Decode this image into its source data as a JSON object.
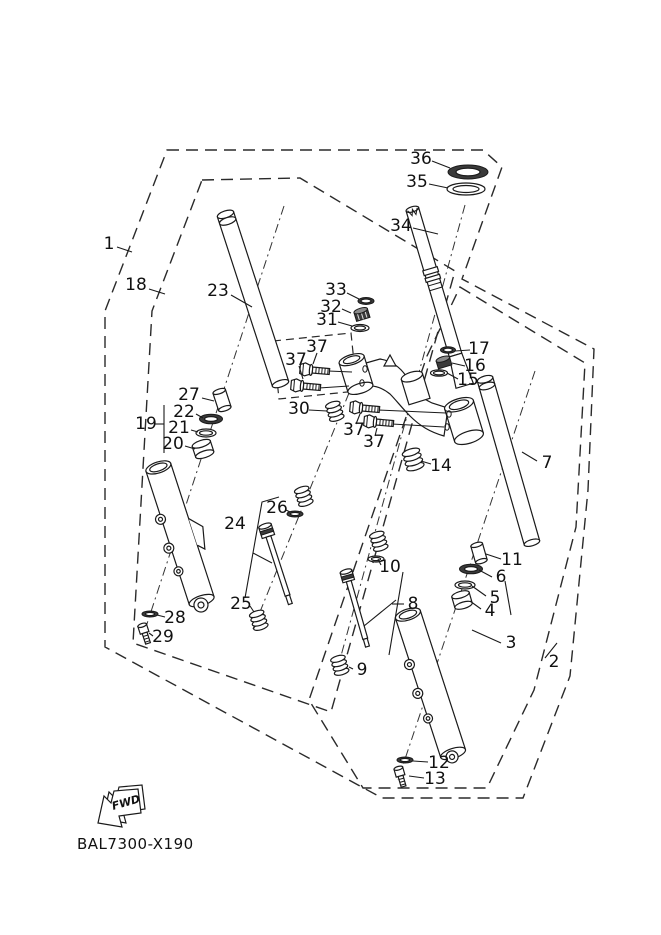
{
  "diagram": {
    "code": "BAL7300-X190",
    "fwd_label": "FWD",
    "colors": {
      "line": "#1a1a1a",
      "background": "#ffffff",
      "seal_dark": "#3a3a3a"
    },
    "labels": [
      {
        "text": "1",
        "x": 109,
        "y": 244,
        "leader": [
          117,
          247,
          132,
          252
        ]
      },
      {
        "text": "18",
        "x": 136,
        "y": 285,
        "leader": [
          149,
          289,
          165,
          294
        ]
      },
      {
        "text": "23",
        "x": 218,
        "y": 291,
        "leader": [
          231,
          295,
          252,
          307
        ]
      },
      {
        "text": "27",
        "x": 189,
        "y": 395,
        "leader": [
          202,
          398,
          214,
          401
        ]
      },
      {
        "text": "22",
        "x": 184,
        "y": 412,
        "leader": [
          196,
          414,
          203,
          418
        ]
      },
      {
        "text": "21",
        "x": 179,
        "y": 428,
        "leader": [
          191,
          430,
          198,
          432
        ]
      },
      {
        "text": "20",
        "x": 173,
        "y": 444,
        "leader": [
          185,
          446,
          195,
          449
        ]
      },
      {
        "text": "19",
        "x": 146,
        "y": 424,
        "leader": [
          154,
          424,
          164,
          424
        ]
      },
      {
        "text": "28",
        "x": 175,
        "y": 618,
        "leader": [
          165,
          617,
          157,
          615
        ]
      },
      {
        "text": "29",
        "x": 163,
        "y": 637,
        "leader": [
          153,
          636,
          149,
          633
        ]
      },
      {
        "text": "24",
        "x": 235,
        "y": 524,
        "leader": null
      },
      {
        "text": "25",
        "x": 241,
        "y": 604,
        "leader": [
          250,
          606,
          254,
          612
        ]
      },
      {
        "text": "26",
        "x": 277,
        "y": 508,
        "leader": [
          286,
          510,
          290,
          512
        ]
      },
      {
        "text": "33",
        "x": 336,
        "y": 290,
        "leader": [
          347,
          293,
          359,
          299
        ]
      },
      {
        "text": "32",
        "x": 331,
        "y": 307,
        "leader": [
          342,
          309,
          351,
          313
        ]
      },
      {
        "text": "31",
        "x": 327,
        "y": 320,
        "leader": [
          338,
          322,
          352,
          326
        ]
      },
      {
        "text": "37",
        "x": 317,
        "y": 347,
        "leader": [
          317,
          353,
          313,
          364
        ]
      },
      {
        "text": "37",
        "x": 296,
        "y": 360,
        "leader": [
          299,
          366,
          303,
          379
        ]
      },
      {
        "text": "30",
        "x": 299,
        "y": 409,
        "leader": [
          309,
          410,
          327,
          411
        ]
      },
      {
        "text": "37",
        "x": 354,
        "y": 430,
        "leader": [
          356,
          424,
          360,
          414
        ]
      },
      {
        "text": "37",
        "x": 374,
        "y": 442,
        "leader": [
          375,
          436,
          377,
          428
        ]
      },
      {
        "text": "34",
        "x": 401,
        "y": 226,
        "leader": [
          413,
          228,
          438,
          234
        ]
      },
      {
        "text": "36",
        "x": 421,
        "y": 159,
        "leader": [
          432,
          161,
          450,
          168
        ]
      },
      {
        "text": "35",
        "x": 417,
        "y": 182,
        "leader": [
          429,
          184,
          448,
          188
        ]
      },
      {
        "text": "17",
        "x": 479,
        "y": 349,
        "leader": [
          470,
          350,
          455,
          351
        ]
      },
      {
        "text": "16",
        "x": 475,
        "y": 366,
        "leader": [
          465,
          366,
          452,
          363
        ]
      },
      {
        "text": "15",
        "x": 468,
        "y": 380,
        "leader": [
          458,
          379,
          447,
          373
        ]
      },
      {
        "text": "14",
        "x": 441,
        "y": 466,
        "leader": [
          431,
          464,
          421,
          461
        ]
      },
      {
        "text": "7",
        "x": 547,
        "y": 463,
        "leader": [
          537,
          461,
          522,
          452
        ]
      },
      {
        "text": "11",
        "x": 512,
        "y": 560,
        "leader": [
          501,
          559,
          486,
          554
        ]
      },
      {
        "text": "6",
        "x": 501,
        "y": 577,
        "leader": [
          492,
          577,
          479,
          570
        ]
      },
      {
        "text": "5",
        "x": 495,
        "y": 598,
        "leader": [
          486,
          596,
          472,
          586
        ]
      },
      {
        "text": "4",
        "x": 490,
        "y": 611,
        "leader": [
          481,
          609,
          470,
          601
        ]
      },
      {
        "text": "3",
        "x": 511,
        "y": 643,
        "leader": [
          501,
          643,
          472,
          630
        ]
      },
      {
        "text": "2",
        "x": 554,
        "y": 662,
        "leader": [
          545,
          658,
          557,
          643
        ]
      },
      {
        "text": "10",
        "x": 390,
        "y": 567,
        "leader": [
          381,
          565,
          378,
          559
        ]
      },
      {
        "text": "8",
        "x": 413,
        "y": 604,
        "leader": [
          404,
          604,
          392,
          604
        ]
      },
      {
        "text": "9",
        "x": 362,
        "y": 670,
        "leader": [
          353,
          669,
          349,
          667
        ]
      },
      {
        "text": "12",
        "x": 439,
        "y": 763,
        "leader": [
          428,
          762,
          413,
          761
        ]
      },
      {
        "text": "13",
        "x": 435,
        "y": 779,
        "leader": [
          424,
          778,
          409,
          776
        ]
      }
    ]
  }
}
